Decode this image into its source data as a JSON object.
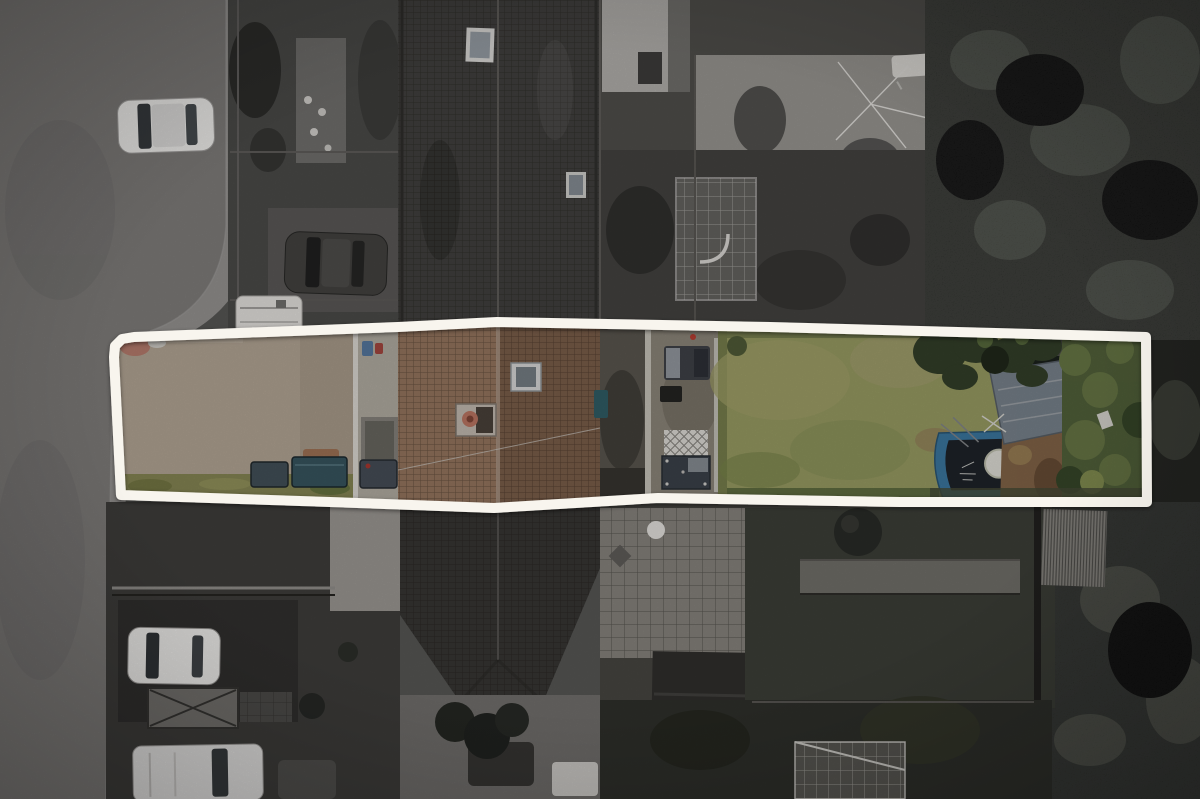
{
  "scene": {
    "kind": "aerial-drone-photograph",
    "description": "Top-down drone photo of a long terraced-house plot. The plot is traced with a thick white boundary line; the interior of the boundary is shown in colour (gravel driveway, brown tiled roof with chimney and skylight, concrete yard and patio, large lawn, covered blue boat with white buoy, grey shed, green shrubs) while all surroundings are desaturated greyscale (road, pavement, parked cars, caravan, neighbouring gardens, greenhouses, sheds and dense tree canopy)."
  },
  "plot": {
    "outline_points": "114,357 115,346 122,339 134,337 398,327 497,322 770,327 1146,337 1147,502 900,502 658,498 494,508 330,502 121,495",
    "outline_width": 10
  },
  "palette": {
    "boundary": "#f8f5ee",
    "base": "#525250",
    "road": "#787674",
    "pavement": "#8d8b89",
    "front_gardens": "#474745",
    "front_gardens_bottom": "#3b3a38",
    "roof_gray": "#3e3d3b",
    "roof_gray_bottom": "#343331",
    "back_gardens": "#4b4a47",
    "gardens_bottom": "#44423e",
    "trees": "#242622",
    "gravel": "#bdae9c",
    "weeds": "#8d8d58",
    "roof_left": "#9e7c64",
    "roof_right": "#82644f",
    "ridge": "#b59f8d",
    "yard": "#5f5b53",
    "patio": "#948d80",
    "grass_verge": "#7d8551",
    "lawn": "#a0a468",
    "lawn_shadow": "#5c6b3e",
    "tree_overhang": "#36422c",
    "bushes": "#57673e",
    "dirt": "#8a6a4c",
    "shed": "#7f8a94",
    "boat_blue": "#3f7da8",
    "boat_cover": "#20252c",
    "buoy_white": "#ebe9e1",
    "chimney_pot": "#c67c68",
    "white_vehicle": "#e6e5e3",
    "dark_vehicle": "#403f3d",
    "bin_teal": "#3a5a64",
    "bin_slate": "#47555e"
  }
}
